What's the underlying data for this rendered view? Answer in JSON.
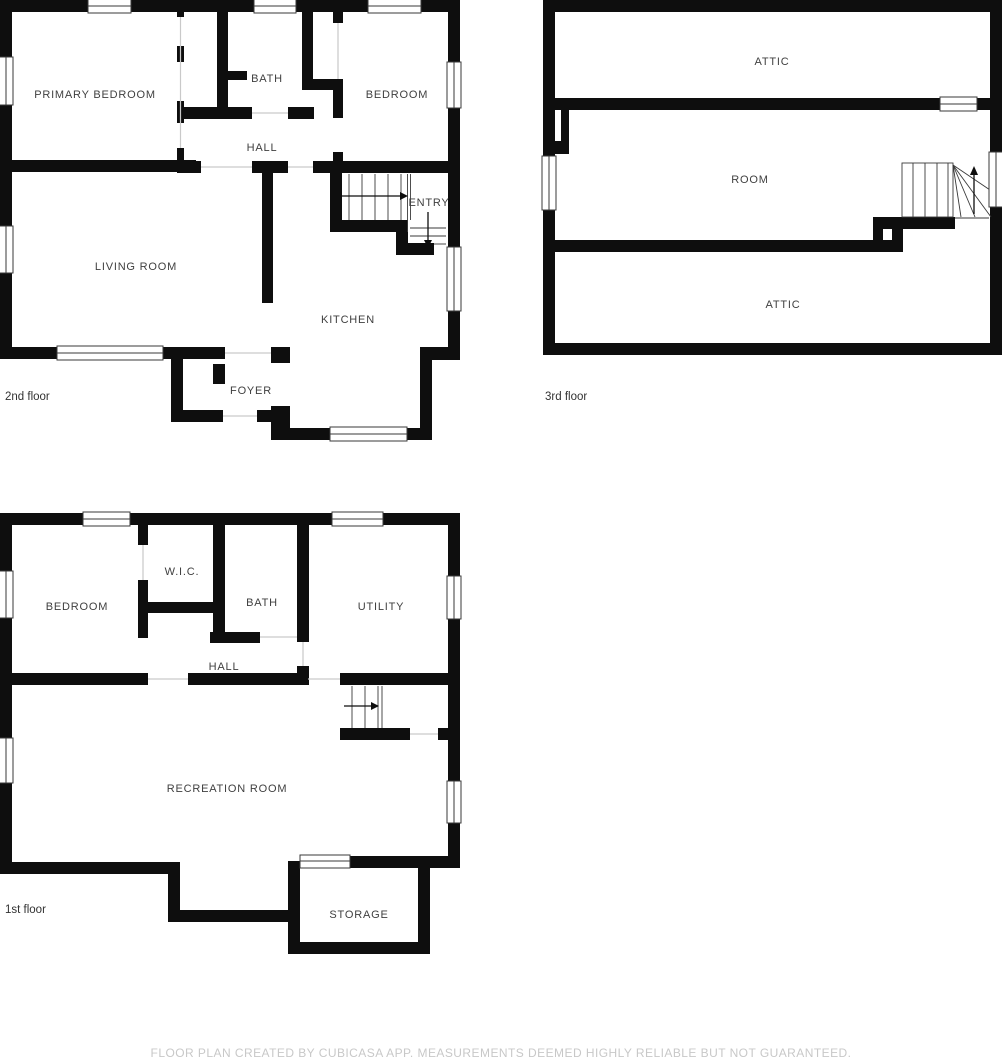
{
  "colors": {
    "wall": "#0e0e0e",
    "line": "#3a3a3a",
    "door_line": "#c9c9c9",
    "room_label": "#3f3f3f",
    "floor_label": "#323232",
    "disclaimer": "#c8c8c8",
    "background": "#ffffff"
  },
  "floors": {
    "second": {
      "caption": "2nd floor",
      "rooms": {
        "primary_bedroom": "PRIMARY BEDROOM",
        "bath": "BATH",
        "bedroom": "BEDROOM",
        "hall": "HALL",
        "entry": "ENTRY",
        "living_room": "LIVING ROOM",
        "kitchen": "KITCHEN",
        "foyer": "FOYER"
      }
    },
    "third": {
      "caption": "3rd floor",
      "rooms": {
        "attic_top": "ATTIC",
        "room": "ROOM",
        "attic_bottom": "ATTIC"
      }
    },
    "first": {
      "caption": "1st floor",
      "rooms": {
        "bedroom": "BEDROOM",
        "wic": "W.I.C.",
        "bath": "BATH",
        "utility": "UTILITY",
        "hall": "HALL",
        "recreation_room": "RECREATION ROOM",
        "storage": "STORAGE"
      }
    }
  },
  "footer": {
    "disclaimer": "FLOOR PLAN CREATED BY CUBICASA APP. MEASUREMENTS DEEMED HIGHLY RELIABLE BUT NOT GUARANTEED."
  }
}
